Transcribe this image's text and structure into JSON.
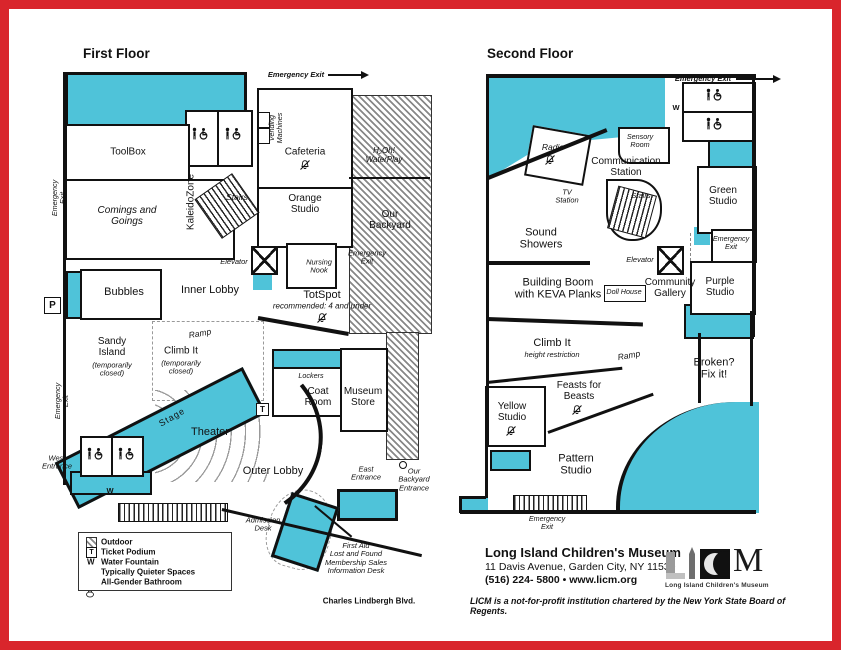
{
  "colors": {
    "teal": "#4fc3d9",
    "frame_red": "#d9252c",
    "wall_black": "#111111"
  },
  "f1": {
    "title": "First Floor",
    "toolbox": "ToolBox",
    "comings": "Comings and\nGoings",
    "kaleido": "KaleidoZone",
    "stairs": "Stairs",
    "vending": "Vending\nMachines",
    "cafeteria": "Cafeteria",
    "h2oh": "H₂Oh!\nWaterPlay",
    "orange": "Orange\nStudio",
    "backyard": "Our\nBackyard",
    "em": "Emergency Exit",
    "emv": "Emergency\nExit",
    "inner": "Inner Lobby",
    "elevator": "Elevator",
    "nursing": "Nursing\nNook",
    "totspot": "TotSpot",
    "totnote": "recommended: 4 and under",
    "bubbles": "Bubbles",
    "sandy": "Sandy\nIsland",
    "closed": "(temporarily\nclosed)",
    "climb": "Climb It",
    "ramp": "Ramp",
    "stage": "Stage",
    "theater": "Theater",
    "west": "West\nEntrance",
    "outer": "Outer Lobby",
    "lockers": "Lockers",
    "coat": "Coat\nRoom",
    "store": "Museum\nStore",
    "east": "East\nEntrance",
    "byent": "Our\nBackyard\nEntrance",
    "admission": "Admission\nDesk",
    "firstaid": "First Aid\nLost and Found\nMembership Sales\nInformation Desk",
    "street": "Charles Lindbergh Blvd.",
    "p": "P",
    "w": "W",
    "t": "T"
  },
  "f2": {
    "title": "Second Floor",
    "radio": "Radio",
    "sensory": "Sensory\nRoom",
    "comm": "Communication\nStation",
    "tv": "TV\nStation",
    "stairs": "Stairs",
    "green": "Green\nStudio",
    "em": "Emergency Exit",
    "emv": "Emergency\nExit",
    "sound": "Sound\nShowers",
    "boom": "Building Boom\nwith KEVA Planks",
    "doll": "Doll House",
    "elevator": "Elevator",
    "community": "Community\nGallery",
    "purple": "Purple\nStudio",
    "climb": "Climb It",
    "climbnote": "height restriction",
    "ramp": "Ramp",
    "broken": "Broken?\nFix it!",
    "yellow": "Yellow\nStudio",
    "feasts": "Feasts for\nBeasts",
    "pattern": "Pattern\nStudio",
    "w": "W"
  },
  "legend": {
    "outdoor": "Outdoor",
    "ticket": "Ticket Podium",
    "water": "Water Fountain",
    "quieter": "Typically Quieter Spaces",
    "bathroom": "All-Gender Bathroom",
    "t": "T",
    "w": "W"
  },
  "footer": {
    "name": "Long Island Children's Museum",
    "address": "11 Davis Avenue, Garden City, NY 11530",
    "phone": "(516) 224- 5800 • www.licm.org",
    "disclaimer": "LICM is a not-for-profit institution chartered by the New York State Board of Regents.",
    "logo_m": "M",
    "logo_caption": "Long Island Children's Museum"
  }
}
